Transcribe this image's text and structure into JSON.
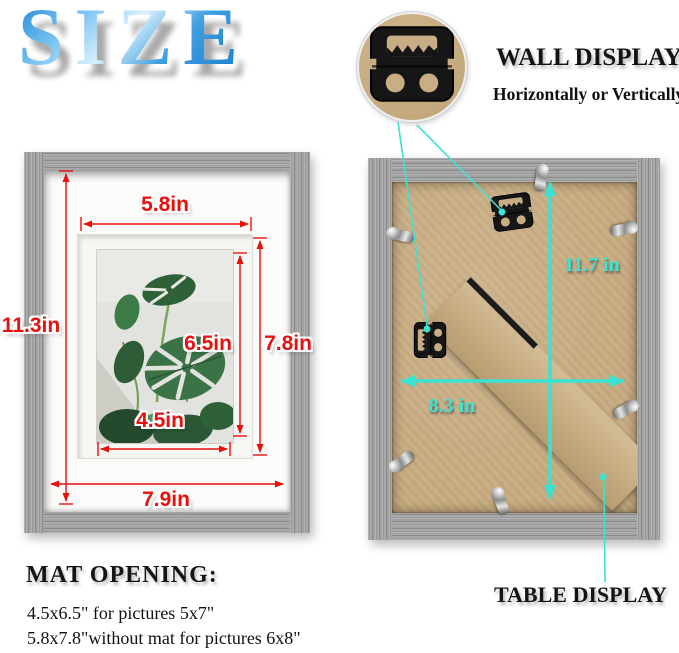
{
  "logo": {
    "text": "SIZE"
  },
  "wall_display": {
    "title": "WALL DISPLAY",
    "subtitle": "Horizontally or Vertically"
  },
  "table_display": {
    "title": "TABLE DISPLAY"
  },
  "mat_opening": {
    "title": "MAT OPENING:",
    "lines": [
      "4.5x6.5\" for pictures 5x7\"",
      "5.8x7.8\"without mat for pictures 6x8\""
    ]
  },
  "front_frame": {
    "mat_opening_width": "5.8in",
    "frame_height": "11.3in",
    "photo_height": "6.5in",
    "mat_opening_height": "7.8in",
    "photo_width": "4.5in",
    "frame_inner_width": "7.9in"
  },
  "back_frame": {
    "height": "11.7 in",
    "width": "8.3 in"
  },
  "colors": {
    "dimension_red": "#e8100c",
    "dimension_cyan": "#3be2d1",
    "logo_blue": "#2b8fd9",
    "frame_gray": "#9c9c9c",
    "kraft_backing": "#c7ab80",
    "mat_white": "#fbfbfa"
  }
}
